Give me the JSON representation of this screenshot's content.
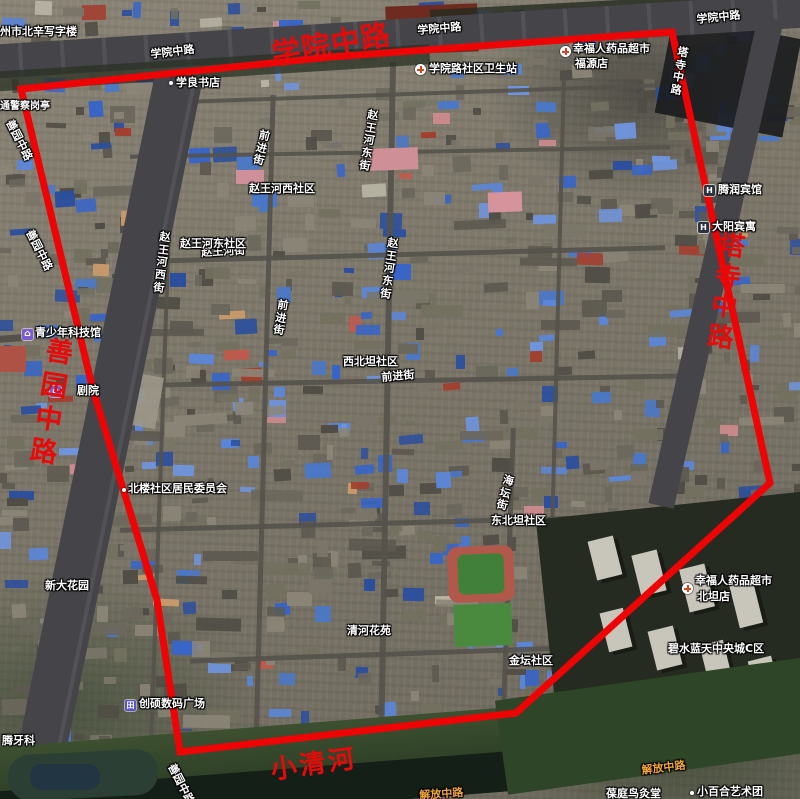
{
  "map": {
    "boundary_color": "#ee0404",
    "big_labels": {
      "north_road": "学院中路",
      "west_road": "善园中路",
      "east_road": "塔寺中路",
      "river": "小清河"
    },
    "road_labels": {
      "xueyuan": "学院中路",
      "tasi": "塔寺中路",
      "shanyuan": "善园中路",
      "jiefang": "解放中路",
      "qianjin": "前进街",
      "zhaowang_dong": "赵王河东街",
      "zhaowang_xi": "赵王河西街",
      "zhaowang": "赵王河街",
      "haitan": "海坛街"
    },
    "area_labels": {
      "zhaowang_xi_c": "赵王河西社区",
      "zhaowang_dong_c": "赵王河东社区",
      "xibeitan": "西北坦社区",
      "dongbeitan": "东北坦社区",
      "jintan": "金坛社区",
      "qinghe": "清河花苑",
      "bishui": "碧水蓝天中央城C区",
      "xinda": "新大花园"
    },
    "poi_labels": {
      "office": "沧州市北辛写字楼",
      "police": "交通警察岗亭",
      "bookstore": "学良书店",
      "clinic": "学院路社区卫生站",
      "pharmacy1_line1": "幸福人药品超市",
      "pharmacy1_line2": "福源店",
      "hotel_tengrun": "腾润宾馆",
      "hotel_dayang": "大阳宾寓",
      "science_museum": "青少年科技馆",
      "theater": "剧院",
      "committee": "北楼社区居民委员会",
      "digital_plaza": "创硕数码广场",
      "dental": "腾牙科",
      "pharmacy2_line1": "幸福人药品超市",
      "pharmacy2_line2": "北坦店",
      "art_troupe": "小百合艺术团",
      "moxibustion": "葆庭鸟灸堂"
    }
  }
}
